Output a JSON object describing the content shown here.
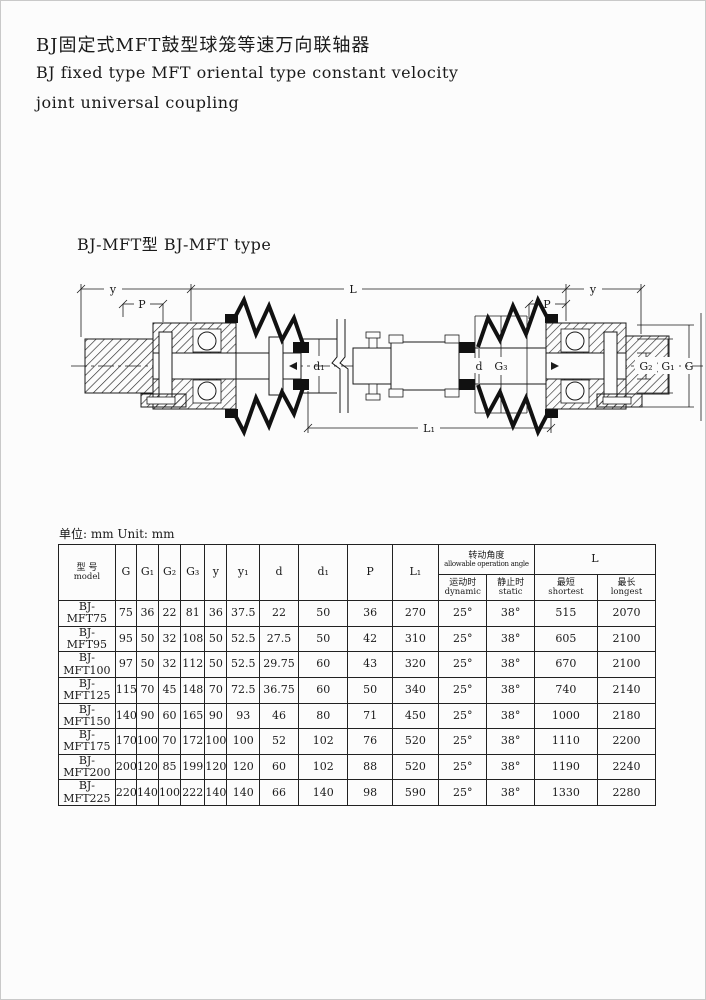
{
  "page": {
    "title_cn": "BJ固定式MFT鼓型球笼等速万向联轴器",
    "title_en_line1": "BJ fixed type MFT oriental type constant velocity",
    "title_en_line2": "joint universal coupling",
    "section_heading": "BJ-MFT型 BJ-MFT type",
    "unit_label": "单位: mm Unit: mm"
  },
  "drawing": {
    "dim_y_left": "y",
    "dim_L": "L",
    "dim_y_right": "y",
    "dim_P_left": "P",
    "dim_P_right": "P",
    "dim_d1": "d₁",
    "dim_d": "d",
    "dim_G3": "G₃",
    "dim_G2": "G₂",
    "dim_G1": "G₁",
    "dim_G": "G",
    "dim_L1": "L₁"
  },
  "table": {
    "headers": {
      "model_cn": "型 号",
      "model_en": "model",
      "g": "G",
      "g1": "G₁",
      "g2": "G₂",
      "g3": "G₃",
      "y": "y",
      "y1": "y₁",
      "d": "d",
      "d1": "d₁",
      "p": "P",
      "l1": "L₁",
      "angle_cn": "转动角度",
      "angle_en": "allowable operation angle",
      "dynamic_cn": "运动时",
      "dynamic_en": "dynamic",
      "static_cn": "静止时",
      "static_en": "static",
      "len": "L",
      "shortest_cn": "最短",
      "shortest_en": "shortest",
      "longest_cn": "最长",
      "longest_en": "longest"
    },
    "rows": [
      [
        "BJ-MFT75",
        "75",
        "36",
        "22",
        "81",
        "36",
        "37.5",
        "22",
        "50",
        "36",
        "270",
        "25°",
        "38°",
        "515",
        "2070"
      ],
      [
        "BJ-MFT95",
        "95",
        "50",
        "32",
        "108",
        "50",
        "52.5",
        "27.5",
        "50",
        "42",
        "310",
        "25°",
        "38°",
        "605",
        "2100"
      ],
      [
        "BJ-MFT100",
        "97",
        "50",
        "32",
        "112",
        "50",
        "52.5",
        "29.75",
        "60",
        "43",
        "320",
        "25°",
        "38°",
        "670",
        "2100"
      ],
      [
        "BJ-MFT125",
        "115",
        "70",
        "45",
        "148",
        "70",
        "72.5",
        "36.75",
        "60",
        "50",
        "340",
        "25°",
        "38°",
        "740",
        "2140"
      ],
      [
        "BJ-MFT150",
        "140",
        "90",
        "60",
        "165",
        "90",
        "93",
        "46",
        "80",
        "71",
        "450",
        "25°",
        "38°",
        "1000",
        "2180"
      ],
      [
        "BJ-MFT175",
        "170",
        "100",
        "70",
        "172",
        "100",
        "100",
        "52",
        "102",
        "76",
        "520",
        "25°",
        "38°",
        "1110",
        "2200"
      ],
      [
        "BJ-MFT200",
        "200",
        "120",
        "85",
        "199",
        "120",
        "120",
        "60",
        "102",
        "88",
        "520",
        "25°",
        "38°",
        "1190",
        "2240"
      ],
      [
        "BJ-MFT225",
        "220",
        "140",
        "100",
        "222",
        "140",
        "140",
        "66",
        "140",
        "98",
        "590",
        "25°",
        "38°",
        "1330",
        "2280"
      ]
    ]
  }
}
